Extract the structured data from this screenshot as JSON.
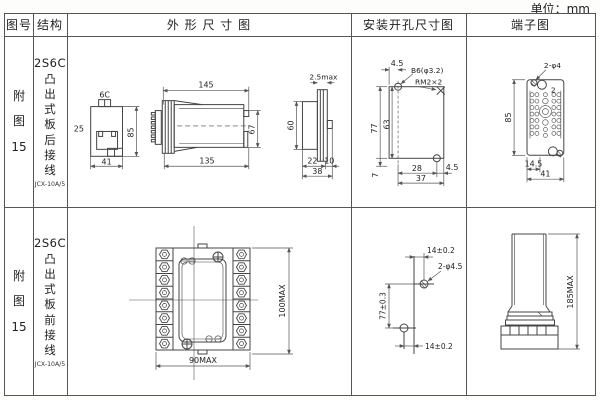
{
  "unit_label": "单位：mm",
  "headers": {
    "fig_no": "图号",
    "structure": "结构",
    "outline": "外 形 尺 寸 图",
    "mounting": "安装开孔尺寸图",
    "terminal": "端子图"
  },
  "rows": [
    {
      "fig_no": "附图15",
      "structure": {
        "model": "2S6C",
        "wiring": "凸出式板后接线",
        "type": "JCX-10A/5"
      },
      "outline": {
        "tab": "6C",
        "left": "25",
        "height": "85",
        "width": "41",
        "top_len": "145",
        "bottom_len": "135",
        "body_h": "67",
        "plate": "2.5max",
        "panel_h": "60",
        "d22": "22",
        "d10": "10",
        "d38": "38"
      },
      "mounting": {
        "offset": "4.5",
        "hole": "B6(φ3.2)",
        "screw": "RM2×2",
        "h77": "77",
        "h63": "63",
        "d7": "7",
        "w28": "28",
        "d45": "4.5",
        "w37": "37"
      },
      "terminal": {
        "holes": "2-φ4",
        "num": "2",
        "height": "85",
        "inner": "14.5",
        "width": "41"
      }
    },
    {
      "fig_no": "附图15",
      "structure": {
        "model": "2S6C",
        "wiring": "凸出式板前接线",
        "type": "JCX-10A/5"
      },
      "outline": {
        "height": "100MAX",
        "width": "90MAX"
      },
      "mounting": {
        "top": "14±0.2",
        "holes": "2-φ4.5",
        "height": "77±0.3",
        "bottom": "14±0.2"
      },
      "terminal": {
        "height": "185MAX"
      }
    }
  ]
}
